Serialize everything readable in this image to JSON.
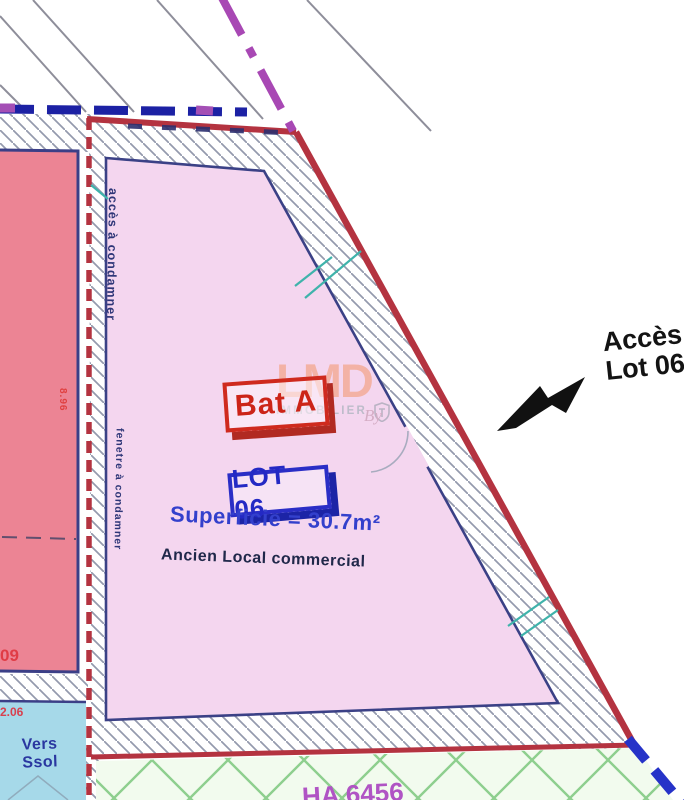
{
  "plan": {
    "title_context": "Plan de lot - Ancien local commercial",
    "labels": {
      "building_stamp": "Bat A",
      "lot_stamp": "LOT 06",
      "superficie": "Superficie = 30.7m²",
      "ancien": "Ancien Local commercial",
      "acces_line1": "Accès",
      "acces_line2": "Lot 06",
      "note_access_left": "accès à condamner",
      "note_window_left": "fenetre à condamner",
      "dim_left_building": "8.96",
      "lot_number_left": "09",
      "dim_bottom_left": "2.06",
      "vers_line1": "Vers",
      "vers_line2": "Ssol",
      "parcel_ref": "HA 6456"
    },
    "watermark": {
      "name": "LMD",
      "tagline": "IMMOBILIER",
      "by": "By"
    },
    "colors": {
      "boundary_red": "#b43340",
      "lot_fill_lavender": "#f4d6ef",
      "neighbor_fill_pink": "#ec8494",
      "bottom_fill_blue": "#a6d9e9",
      "stamp_red": "#cc2418",
      "stamp_blue": "#2329c4",
      "dashed_purple": "#a848b4",
      "dashed_navy": "#1c21a4",
      "dashed_blue_br": "#2633c8",
      "lattice_green": "#8ecf8e",
      "arrow_black": "#111111"
    }
  }
}
